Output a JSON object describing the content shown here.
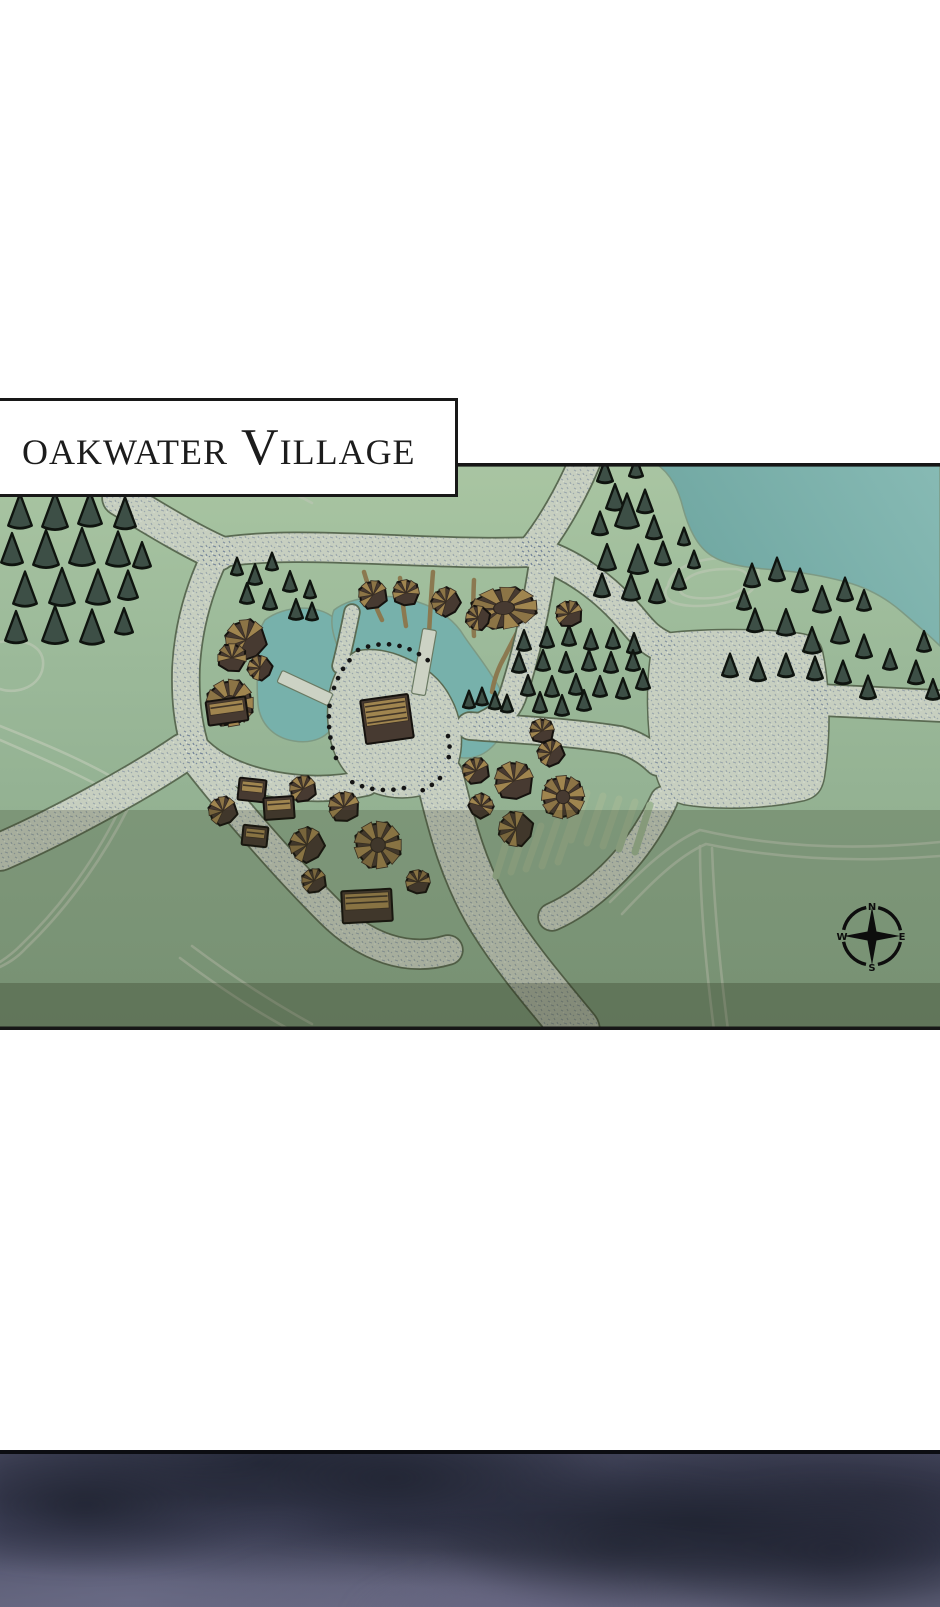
{
  "title": {
    "text": "oakwater Village"
  },
  "compass": {
    "n": "N",
    "e": "E",
    "s": "S",
    "w": "W"
  },
  "colors": {
    "grass_top": "#a9c5a2",
    "grass_mid": "#99b797",
    "grass_low": "#8cab8c",
    "lake_light": "#87bab4",
    "lake_dark": "#6ba39e",
    "pond": "#77b1ab",
    "shore": "#7d9a84",
    "road_fill": "#c7cfc0",
    "road_edge": "#5a6a52",
    "speckle": "#6d7f96",
    "contour": "#b5c4ae",
    "dirt": "#8b7950",
    "field": "#9eb694",
    "tree_fill": "#3d4f46",
    "tree_edge": "#0f140f",
    "roof_dark": "#473a31",
    "roof_tan": "#a0854f",
    "roof_tan2": "#8c7446",
    "roof_edge": "#15120e",
    "pier": "#ccd2c4",
    "fence": "#141414",
    "border": "#161616",
    "band2": "rgba(42,46,18,0.20)",
    "band3": "rgba(33,38,15,0.40)",
    "night_base": "#44465c"
  },
  "map": {
    "lake": "M 655,463 L 940,463 L 940,646 C 930,636 916,624 902,612 C 886,598 868,588 846,582 C 824,576 800,572 776,570 C 752,568 728,566 712,556 C 696,546 688,526 683,508 C 679,492 672,474 655,463 Z",
    "ponds": [
      "M 265,620 C 285,605 318,604 334,618 C 348,630 346,652 342,672 C 339,688 342,704 336,720 C 330,738 312,744 294,741 C 274,738 260,724 258,704 C 256,684 258,664 258,646 C 258,634 260,628 265,620 Z",
      "M 334,610 C 352,596 390,592 418,602 C 440,609 456,622 464,636 C 472,648 482,660 492,676 C 502,690 510,706 506,722 C 501,742 486,757 468,758 C 450,759 440,746 437,732 C 434,718 424,706 406,698 C 386,690 362,676 348,662 C 336,650 328,624 334,610 Z"
    ],
    "plazas": [
      "M 654,638 C 646,678 646,730 656,772 C 660,790 668,800 684,804 C 720,810 768,808 804,800 C 816,797 822,790 824,776 C 830,736 830,690 822,652 C 820,642 814,636 800,634 C 756,628 692,630 664,634 C 658,635 655,636 654,638 Z",
      "M 356,652 C 334,664 324,696 330,734 C 336,770 360,794 396,797 C 426,799 450,786 458,762 C 464,740 460,716 450,698 C 441,680 424,666 404,658 C 388,651 370,648 356,652 Z"
    ],
    "roads": [
      {
        "d": "M 585,461 C 572,492 552,528 532,552",
        "w": 30
      },
      {
        "d": "M 120,498 C 150,516 185,538 218,553",
        "w": 34
      },
      {
        "d": "M 212,554 C 290,538 420,556 532,552",
        "w": 28
      },
      {
        "d": "M 532,552 C 570,562 606,588 634,622 C 644,634 650,640 662,646",
        "w": 30
      },
      {
        "d": "M 820,700 C 858,702 904,704 940,706",
        "w": 30
      },
      {
        "d": "M 214,558 C 198,592 188,630 186,668 C 185,700 188,722 194,744",
        "w": 26
      },
      {
        "d": "M 190,740 C 210,766 244,780 284,786 C 312,790 340,789 366,783",
        "w": 24
      },
      {
        "d": "M 184,752 C 140,782 60,826 0,852",
        "w": 36
      },
      {
        "d": "M 196,760 C 232,806 284,866 330,912 C 366,948 408,962 448,950",
        "w": 28
      },
      {
        "d": "M 440,778 C 452,828 464,874 492,920 C 518,962 550,998 576,1030",
        "w": 46
      },
      {
        "d": "M 544,556 C 538,598 528,648 514,692 C 510,706 500,718 486,724",
        "w": 26
      },
      {
        "d": "M 470,726 C 520,730 570,732 620,740 C 635,744 648,752 658,762",
        "w": 26
      },
      {
        "d": "M 664,800 C 650,830 630,858 606,880 C 588,897 570,909 552,917",
        "w": 26
      },
      {
        "d": "M 352,612 C 348,632 344,650 340,666",
        "w": 14
      }
    ],
    "piers": [
      [
        305,
        688,
        56,
        13,
        25
      ],
      [
        424,
        662,
        14,
        66,
        10
      ]
    ],
    "dirt": [
      "M 364,572 C 370,592 376,608 382,620",
      "M 400,578 C 402,598 404,614 406,626",
      "M 433,572 C 431,596 430,616 429,634",
      "M 474,580 C 473,602 473,620 474,636",
      "M 540,588 C 528,612 515,636 505,656 C 498,668 494,680 492,692"
    ],
    "fences": [
      "M 358,650 Q 396,634 430,662",
      "M 448,736 Q 452,752 446,766",
      "M 440,778 Q 430,788 416,793",
      "M 404,788 Q 376,794 352,782",
      "M 336,758 Q 326,732 330,702",
      "M 334,688 Q 342,666 354,656"
    ],
    "contours": [
      "M 196,472 C 240,462 282,470 318,492",
      "M 206,487 C 246,477 280,485 312,503",
      "M 0,642 C 30,637 48,650 42,671 C 36,689 14,694 0,689",
      "M 668,586 C 672,566 700,556 740,558 C 762,560 762,576 752,590 C 736,606 690,610 672,602 C 664,597 664,591 668,586 Z",
      "M 682,586 C 686,574 706,568 736,569 C 750,571 750,580 742,589 C 728,599 696,601 684,595 C 679,592 679,589 682,586 Z",
      "M 0,726 C 50,746 102,768 136,792 C 108,852 70,906 26,948 C 17,958 8,963 0,967",
      "M 0,740 C 46,760 92,780 124,800 C 98,856 62,906 20,946 C 13,953 6,958 0,962",
      "M 180,958 C 220,988 258,1013 298,1034",
      "M 192,946 C 232,976 272,1002 312,1024",
      "M 610,902 C 640,872 668,844 700,830 C 760,844 840,852 940,842",
      "M 622,914 C 650,884 678,856 706,844 C 764,856 842,864 940,856",
      "M 700,846 C 700,900 706,968 714,1030",
      "M 712,848 C 714,902 720,968 728,1030"
    ],
    "fields": [
      [
        587,
        793,
        571,
        840
      ],
      [
        603,
        796,
        587,
        843
      ],
      [
        619,
        799,
        603,
        846
      ],
      [
        635,
        802,
        619,
        849
      ],
      [
        650,
        805,
        635,
        852
      ],
      [
        573,
        818,
        558,
        862
      ],
      [
        557,
        822,
        542,
        866
      ],
      [
        541,
        826,
        526,
        869
      ],
      [
        525,
        830,
        511,
        872
      ],
      [
        509,
        834,
        496,
        876
      ]
    ],
    "trees": [
      [
        20,
        512,
        12
      ],
      [
        55,
        512,
        13
      ],
      [
        90,
        510,
        12
      ],
      [
        125,
        514,
        11
      ],
      [
        12,
        550,
        11
      ],
      [
        46,
        550,
        13
      ],
      [
        82,
        548,
        13
      ],
      [
        118,
        550,
        12
      ],
      [
        142,
        556,
        9
      ],
      [
        25,
        590,
        12
      ],
      [
        62,
        588,
        13
      ],
      [
        98,
        588,
        12
      ],
      [
        128,
        586,
        10
      ],
      [
        16,
        628,
        11
      ],
      [
        55,
        626,
        13
      ],
      [
        92,
        628,
        12
      ],
      [
        124,
        622,
        9
      ],
      [
        237,
        567,
        6
      ],
      [
        255,
        575,
        7
      ],
      [
        272,
        562,
        6
      ],
      [
        290,
        582,
        7
      ],
      [
        247,
        594,
        7
      ],
      [
        270,
        600,
        7
      ],
      [
        296,
        610,
        7
      ],
      [
        310,
        590,
        6
      ],
      [
        312,
        612,
        6
      ],
      [
        605,
        472,
        8
      ],
      [
        636,
        468,
        7
      ],
      [
        615,
        498,
        9
      ],
      [
        645,
        502,
        8
      ],
      [
        600,
        524,
        8
      ],
      [
        627,
        512,
        12
      ],
      [
        654,
        528,
        8
      ],
      [
        607,
        558,
        9
      ],
      [
        638,
        560,
        10
      ],
      [
        663,
        554,
        8
      ],
      [
        602,
        586,
        8
      ],
      [
        631,
        588,
        9
      ],
      [
        657,
        592,
        8
      ],
      [
        679,
        580,
        7
      ],
      [
        684,
        537,
        6
      ],
      [
        694,
        560,
        6
      ],
      [
        752,
        576,
        8
      ],
      [
        777,
        570,
        8
      ],
      [
        800,
        581,
        8
      ],
      [
        822,
        600,
        9
      ],
      [
        845,
        590,
        8
      ],
      [
        864,
        601,
        7
      ],
      [
        755,
        621,
        8
      ],
      [
        786,
        623,
        9
      ],
      [
        812,
        641,
        9
      ],
      [
        840,
        631,
        9
      ],
      [
        864,
        647,
        8
      ],
      [
        744,
        600,
        7
      ],
      [
        730,
        666,
        8
      ],
      [
        758,
        670,
        8
      ],
      [
        786,
        666,
        8
      ],
      [
        815,
        669,
        8
      ],
      [
        843,
        673,
        8
      ],
      [
        868,
        688,
        8
      ],
      [
        890,
        660,
        7
      ],
      [
        916,
        673,
        8
      ],
      [
        933,
        690,
        7
      ],
      [
        924,
        642,
        7
      ],
      [
        524,
        641,
        7
      ],
      [
        547,
        638,
        7
      ],
      [
        569,
        636,
        7
      ],
      [
        591,
        640,
        7
      ],
      [
        613,
        639,
        7
      ],
      [
        634,
        644,
        7
      ],
      [
        519,
        663,
        7
      ],
      [
        543,
        661,
        7
      ],
      [
        566,
        663,
        7
      ],
      [
        589,
        661,
        7
      ],
      [
        611,
        663,
        7
      ],
      [
        633,
        661,
        7
      ],
      [
        528,
        686,
        7
      ],
      [
        552,
        687,
        7
      ],
      [
        576,
        685,
        7
      ],
      [
        600,
        687,
        7
      ],
      [
        623,
        689,
        7
      ],
      [
        643,
        680,
        7
      ],
      [
        469,
        700,
        6
      ],
      [
        482,
        697,
        6
      ],
      [
        495,
        701,
        6
      ],
      [
        507,
        704,
        6
      ],
      [
        540,
        703,
        7
      ],
      [
        562,
        706,
        7
      ],
      [
        584,
        701,
        7
      ]
    ],
    "huts": [
      [
        373,
        595,
        14,
        0
      ],
      [
        406,
        593,
        13,
        30
      ],
      [
        446,
        602,
        14,
        -20
      ],
      [
        478,
        618,
        12,
        -40
      ],
      [
        569,
        614,
        13,
        10
      ],
      [
        246,
        640,
        20,
        -10
      ],
      [
        232,
        658,
        14,
        40
      ],
      [
        260,
        668,
        12,
        -30
      ],
      [
        476,
        771,
        13,
        0
      ],
      [
        514,
        781,
        19,
        15
      ],
      [
        551,
        753,
        13,
        -15
      ],
      [
        481,
        806,
        12,
        70
      ],
      [
        516,
        829,
        17,
        -40
      ],
      [
        542,
        731,
        12,
        20
      ],
      [
        223,
        811,
        14,
        -10
      ],
      [
        303,
        789,
        13,
        0
      ],
      [
        344,
        807,
        15,
        10
      ],
      [
        307,
        845,
        17,
        -20
      ],
      [
        314,
        881,
        12,
        0
      ],
      [
        418,
        882,
        12,
        30
      ]
    ],
    "radial_huts": [
      [
        504,
        608,
        26,
        -5,
        1.25,
        0.78
      ],
      [
        230,
        703,
        23,
        0,
        1,
        1
      ],
      [
        378,
        845,
        23,
        0,
        1,
        1
      ],
      [
        563,
        797,
        21,
        25,
        1,
        1
      ]
    ],
    "houses": [
      [
        227,
        711,
        40,
        24,
        -8
      ],
      [
        252,
        790,
        27,
        22,
        6
      ],
      [
        279,
        808,
        30,
        22,
        -4
      ],
      [
        255,
        836,
        25,
        20,
        6
      ],
      [
        367,
        906,
        50,
        32,
        -3
      ],
      [
        387,
        719,
        48,
        44,
        -8
      ]
    ],
    "bands": {
      "band2_y": 810,
      "band2_h": 173,
      "band3_y": 983,
      "band3_h": 43.5
    },
    "borders": {
      "top_y": 463,
      "bottom_y": 1026.5,
      "thickness": 3.6
    }
  }
}
